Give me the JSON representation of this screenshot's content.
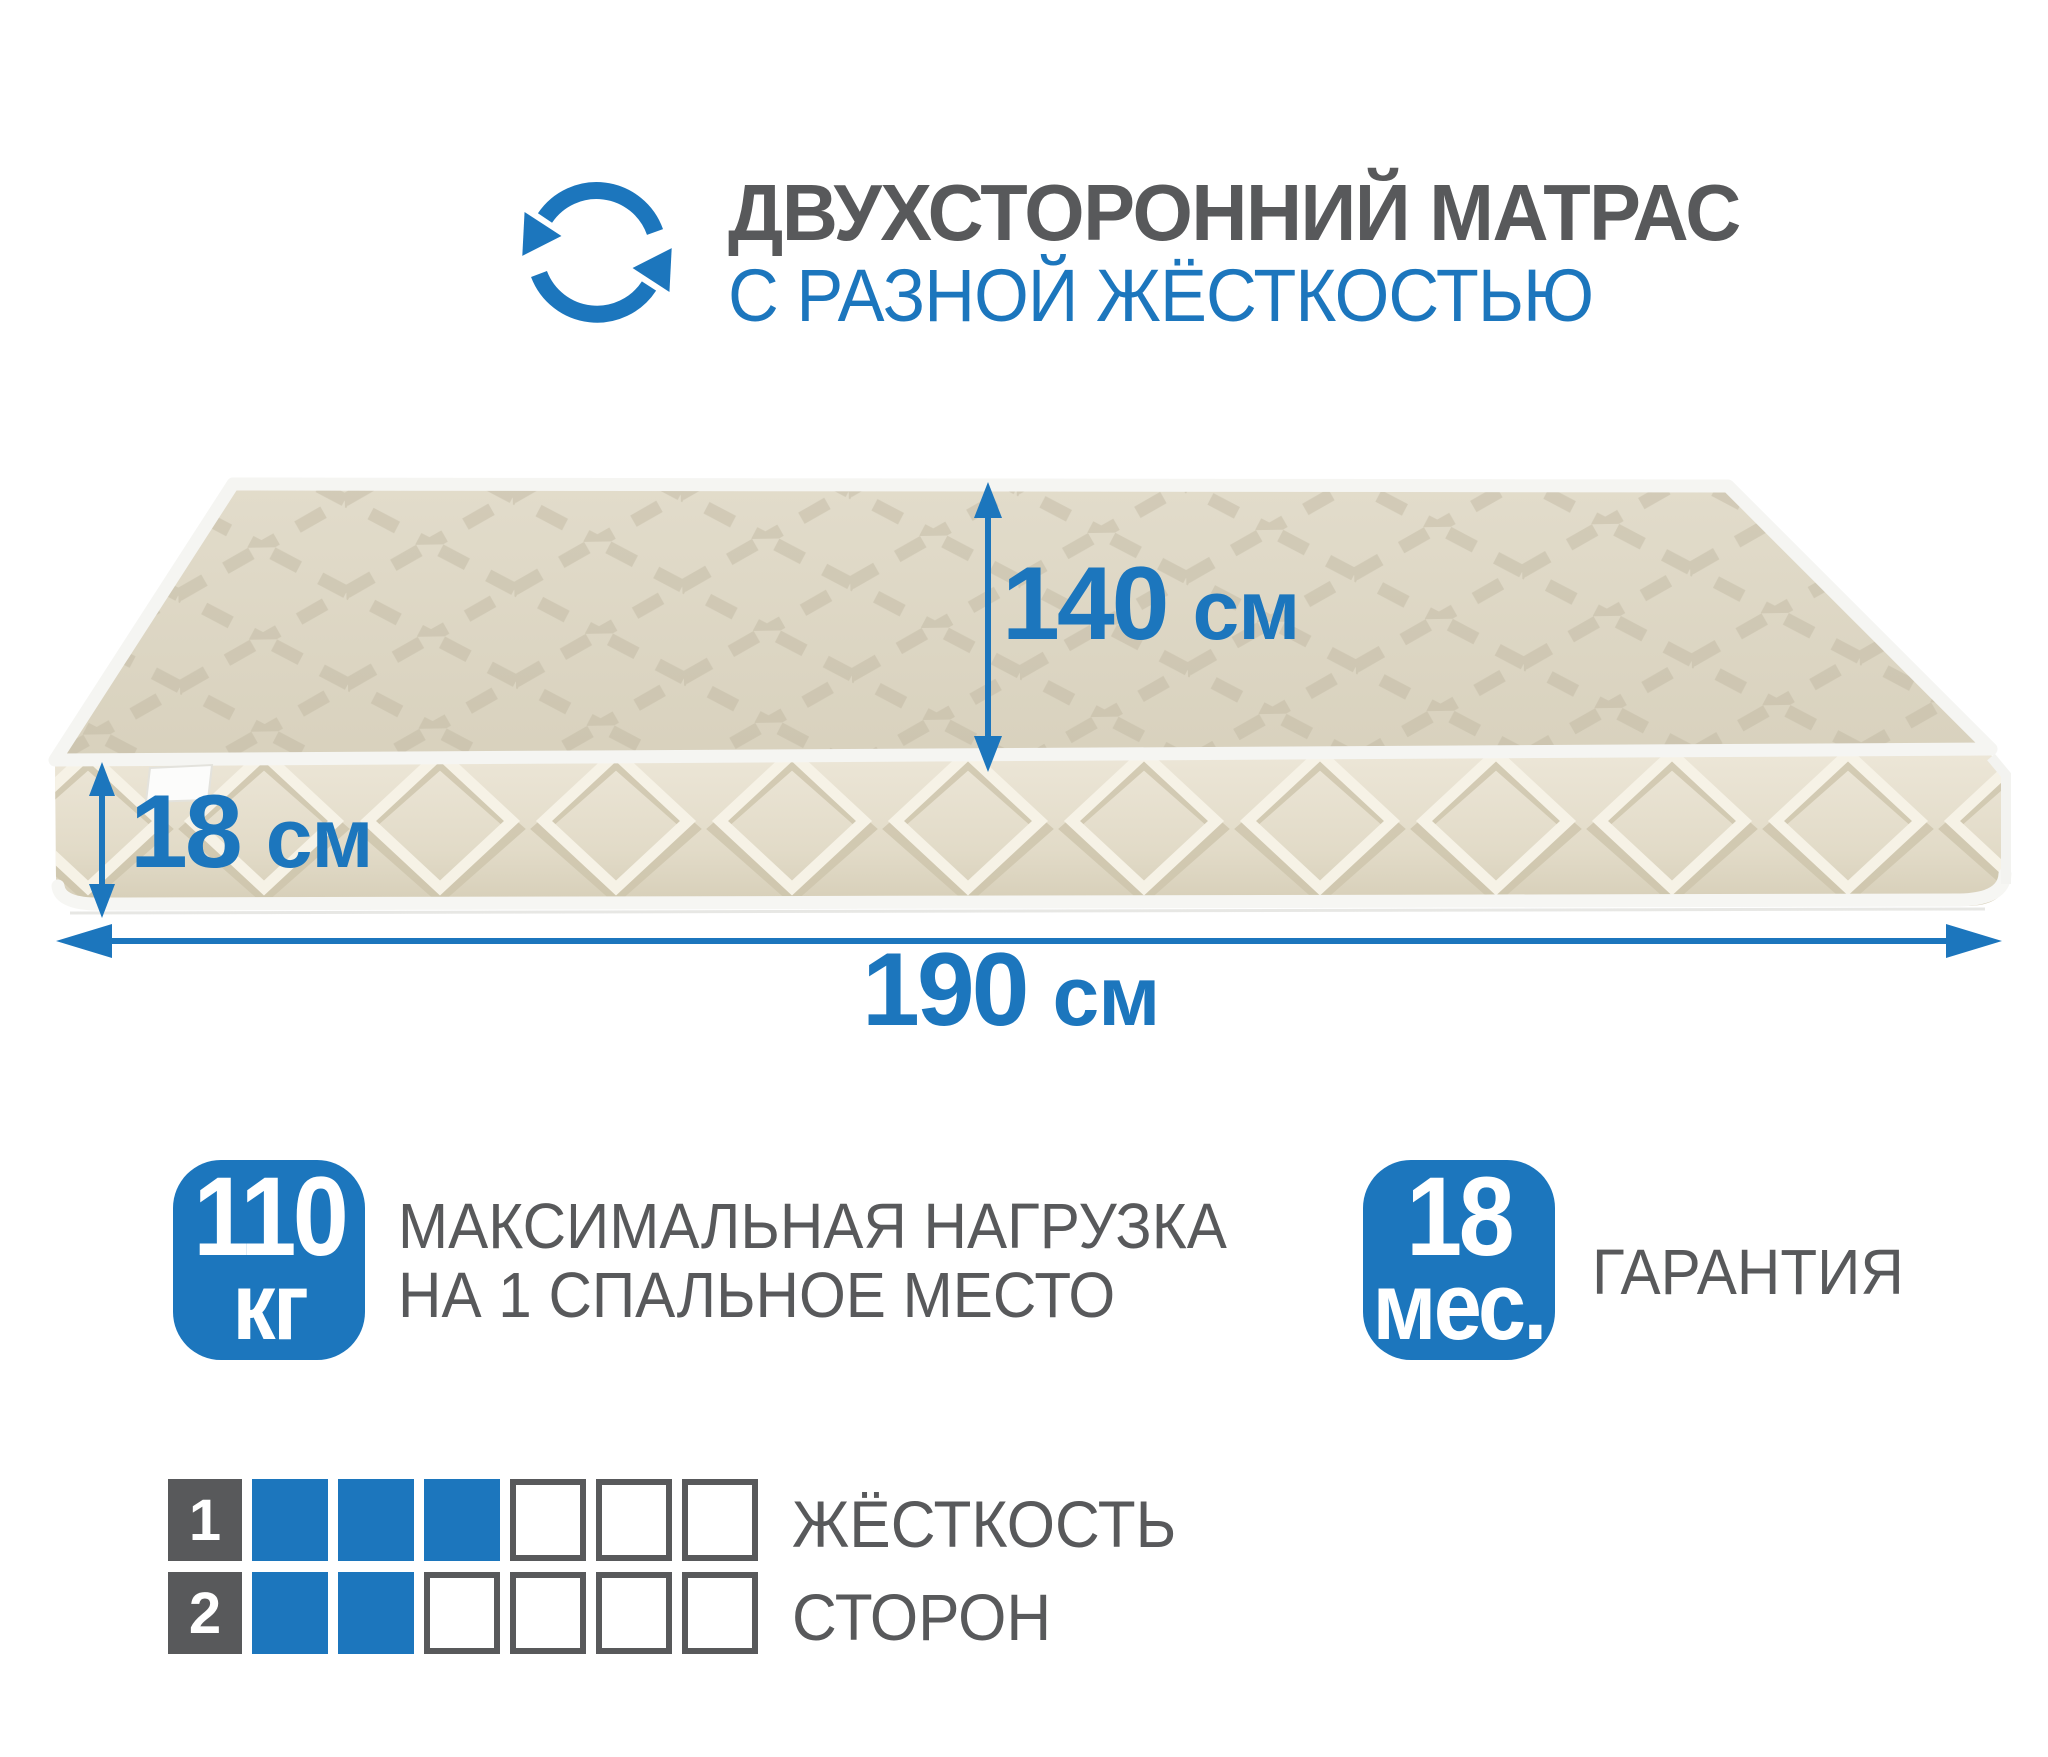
{
  "header": {
    "title": "ДВУХСТОРОННИЙ МАТРАС",
    "subtitle": "С РАЗНОЙ ЖЁСТКОСТЬЮ"
  },
  "dimensions": {
    "width": {
      "value": "140",
      "unit": "см"
    },
    "height": {
      "value": "18",
      "unit": "см"
    },
    "length": {
      "value": "190",
      "unit": "см"
    }
  },
  "badges": {
    "max_load": {
      "value": "110",
      "unit": "кг",
      "label_line1": "МАКСИМАЛЬНАЯ НАГРУЗКА",
      "label_line2": "НА 1 СПАЛЬНОЕ МЕСТО"
    },
    "warranty": {
      "value": "18",
      "unit": "мес.",
      "label": "ГАРАНТИЯ"
    }
  },
  "firmness": {
    "label_line1": "ЖЁСТКОСТЬ",
    "label_line2": "СТОРОН",
    "scale_max": 6,
    "sides": [
      {
        "side": "1",
        "level": 3
      },
      {
        "side": "2",
        "level": 2
      }
    ]
  },
  "colors": {
    "accent_blue": "#1c76bd",
    "text_gray": "#58595b"
  }
}
